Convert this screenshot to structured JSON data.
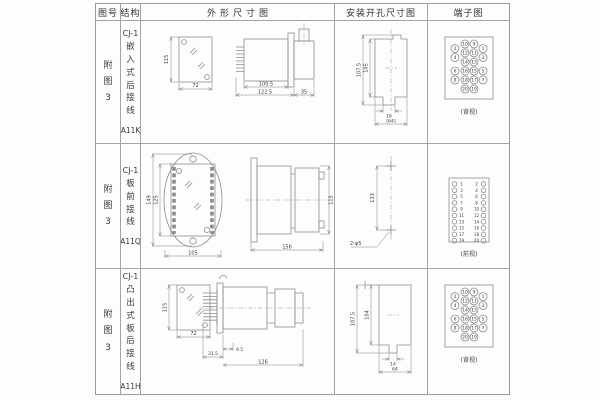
{
  "document": {
    "headers": [
      "图号",
      "结构",
      "外形尺寸图",
      "安装开孔尺寸图",
      "端子图"
    ],
    "rows": [
      {
        "fig_no": "附图3",
        "model": "CJ-1",
        "mount_type": "嵌入式后接线",
        "code": "A11K",
        "outline": {
          "front_height": "115",
          "front_width": "72",
          "body_length": "100.5",
          "total_length": "122.5",
          "rear_length": "35"
        },
        "cutout": {
          "outer_height": "107.5",
          "inner_height": "105",
          "notch_width": "16",
          "opening_width": "[64]"
        },
        "terminals": {
          "style": "rear-grid",
          "view_label": "(背视)",
          "outer_left": [
            "2",
            "4",
            "6",
            "8"
          ],
          "inner_left": [
            "10",
            "12",
            "14",
            "16",
            "18",
            "20"
          ],
          "inner_right": [
            "9",
            "11",
            "13",
            "15",
            "17",
            "19"
          ],
          "outer_right": [
            "1",
            "3",
            "5",
            "7"
          ]
        }
      },
      {
        "fig_no": "附图3",
        "model": "CJ-1",
        "mount_type": "板前接线",
        "code": "A11Q",
        "outline": {
          "front_outer_height": "149",
          "front_inner_height": "125",
          "front_width": "105",
          "side_length": "156",
          "side_height": "115"
        },
        "cutout": {
          "hole_spacing": "133",
          "holes_label": "2-φ5"
        },
        "terminals": {
          "style": "front-strip",
          "view_label": "(前视)",
          "left": [
            "1",
            "3",
            "5",
            "7",
            "9",
            "11",
            "13",
            "15",
            "17",
            "19"
          ],
          "right": [
            "2",
            "4",
            "6",
            "8",
            "10",
            "12",
            "14",
            "16",
            "18",
            "20"
          ]
        }
      },
      {
        "fig_no": "附图3",
        "model": "CJ-1",
        "mount_type": "凸出式板后接线",
        "code": "A11H",
        "outline": {
          "front_height": "115",
          "front_width": "72",
          "pin_length": "31.5",
          "offset": "9.5",
          "body_length": "126"
        },
        "cutout": {
          "outer_height": "107.5",
          "inner_height": "104",
          "notch_width": "14",
          "opening_width": "64"
        },
        "terminals": {
          "style": "rear-grid",
          "view_label": "(背视)",
          "outer_left": [
            "2",
            "4",
            "6",
            "8"
          ],
          "inner_left": [
            "10",
            "12",
            "14",
            "16",
            "18",
            "20"
          ],
          "inner_right": [
            "9",
            "11",
            "13",
            "15",
            "17",
            "19"
          ],
          "outer_right": [
            "1",
            "3",
            "5",
            "7"
          ]
        }
      }
    ]
  }
}
